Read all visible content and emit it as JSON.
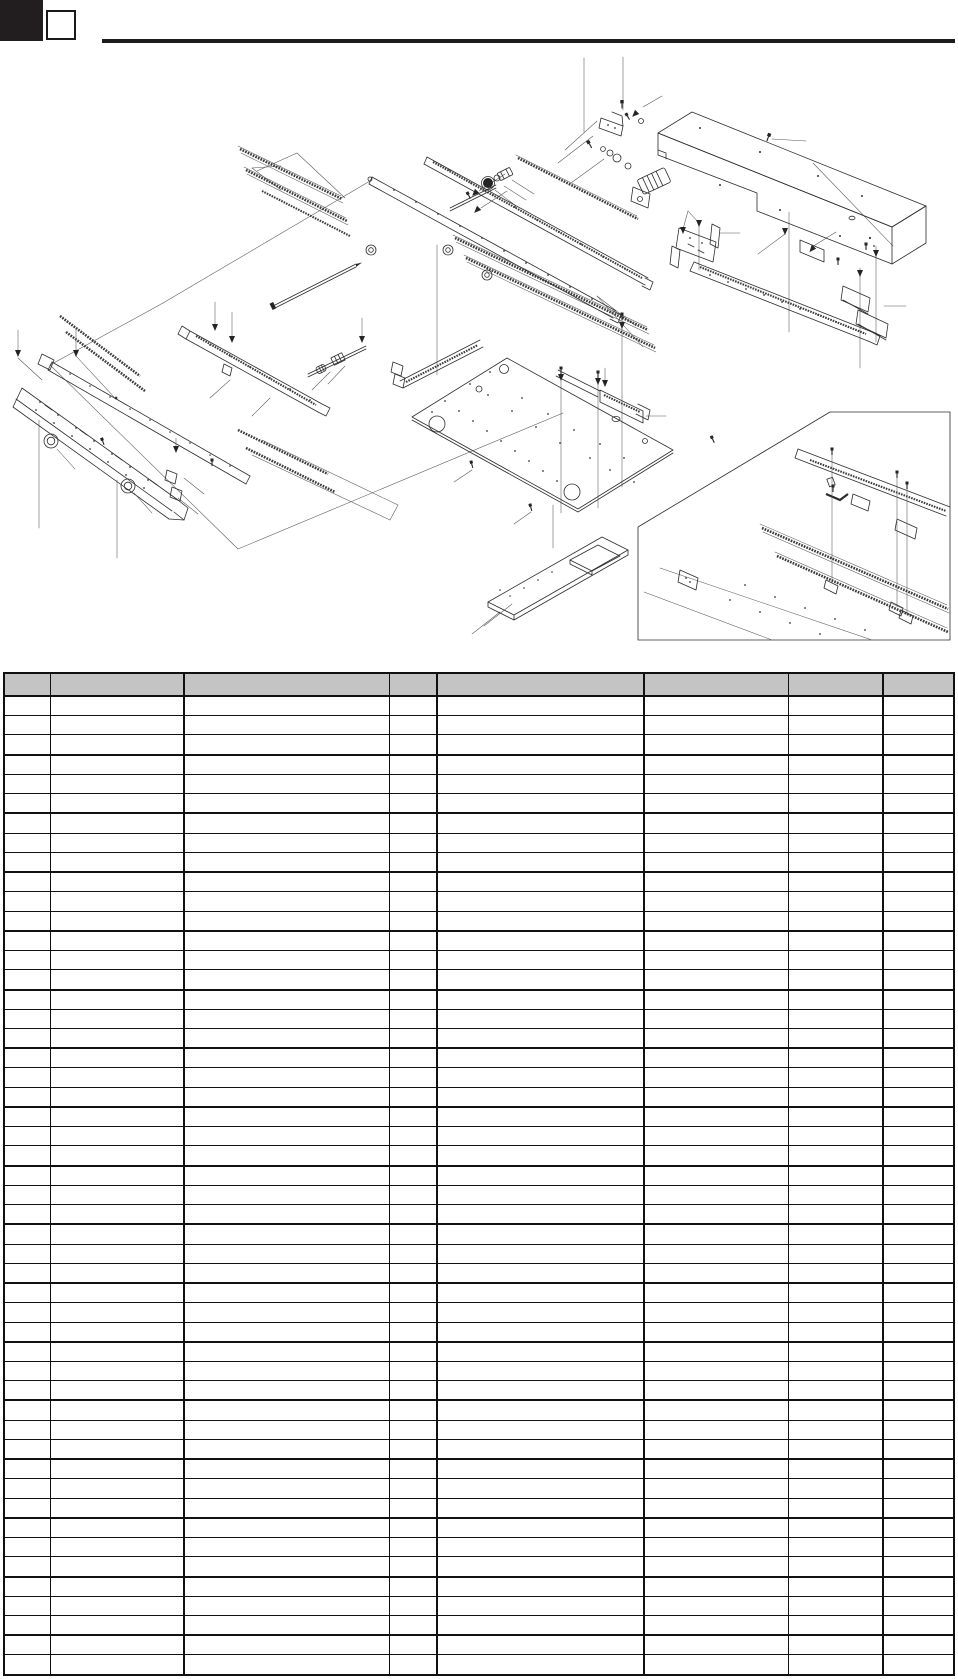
{
  "page": {
    "width": 958,
    "height": 1679,
    "background": "#ffffff"
  },
  "masthead": {
    "tab_fill": "#221e1f",
    "rule_fill": "#1c1c1c",
    "page_box_text": ""
  },
  "figure": {
    "kind": "exploded-parts-diagram",
    "stroke_color": "#2c2c2c",
    "has_detail_inset": true
  },
  "parts_table": {
    "x": 3,
    "y": 672,
    "width": 952,
    "height": 1004,
    "header_fill": "#c4c4c4",
    "grid_color": "#111111",
    "outer_border": 2,
    "header_height": 23,
    "header_bottom_border": 2.8,
    "row_count": 50,
    "thick_row_interval": 3,
    "thin_row_border": 1,
    "thick_row_border": 2.2,
    "columns": [
      {
        "width": 46
      },
      {
        "width": 134
      },
      {
        "width": 205
      },
      {
        "width": 48
      },
      {
        "width": 207
      },
      {
        "width": 144
      },
      {
        "width": 95
      },
      {
        "width": 73
      }
    ],
    "col_border_widths": [
      1.5,
      2,
      1,
      2.5,
      2.5,
      1,
      2.5
    ],
    "headers": [
      "",
      "",
      "",
      "",
      "",
      "",
      "",
      ""
    ]
  }
}
